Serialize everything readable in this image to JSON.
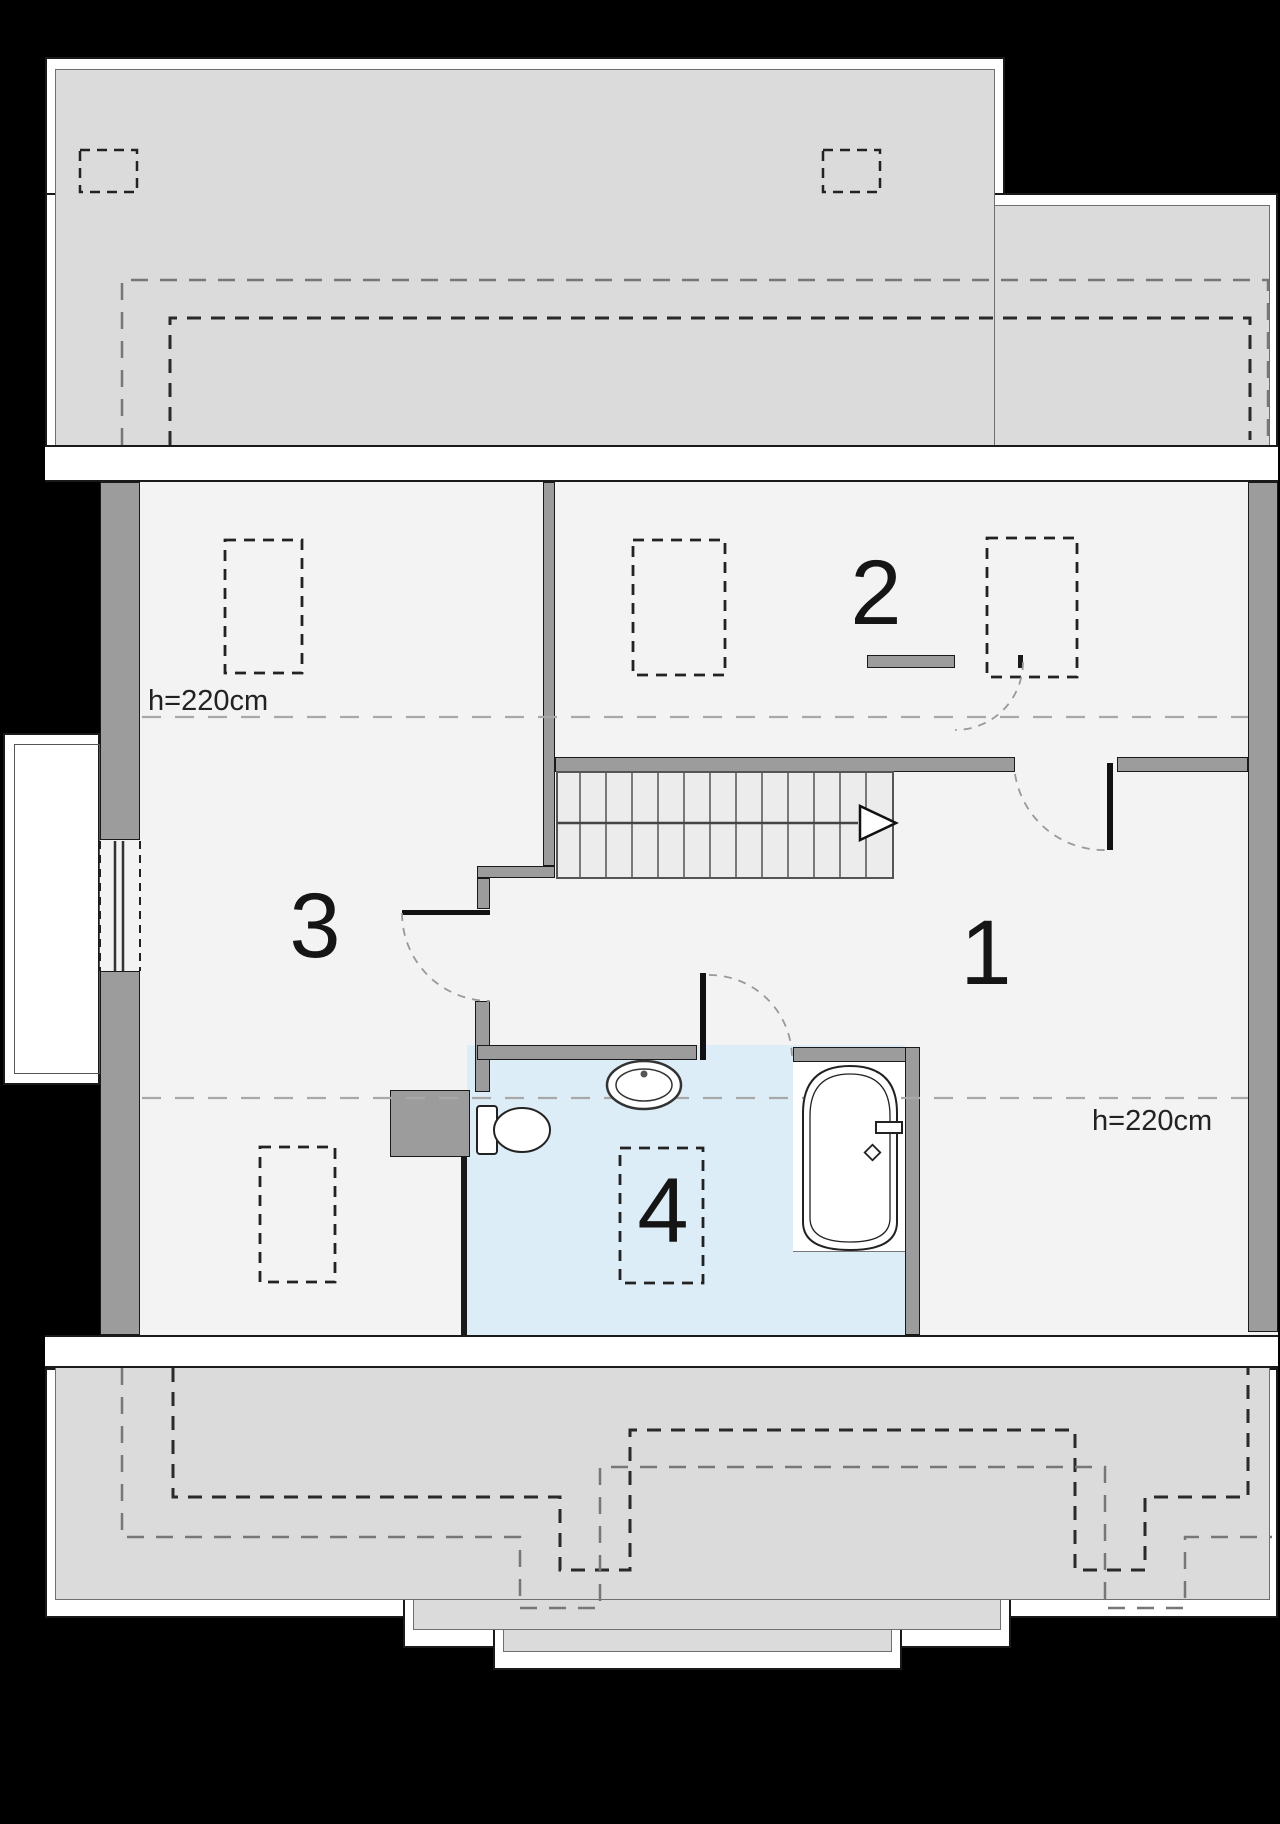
{
  "title": "Attic floor plan",
  "rooms": [
    {
      "number": "1"
    },
    {
      "number": "2"
    },
    {
      "number": "3"
    },
    {
      "number": "4"
    }
  ],
  "annotations": {
    "height_left": "h=220cm",
    "height_right": "h=220cm"
  },
  "fixtures": [
    "staircase",
    "direction-arrow",
    "bathtub",
    "washbasin",
    "toilet",
    "window",
    "door-swing"
  ],
  "colors": {
    "background": "#000000",
    "roof": "#dbdbdb",
    "floor": "#f3f3f3",
    "wall": "#9c9c9c",
    "bathroom": "#ddedf7",
    "stairs": "#ececec",
    "white": "#ffffff",
    "outline": "#1a1a1a",
    "dash_dark": "#2a2a2a",
    "dash_gray": "#777777",
    "height_line": "#a8a8a8"
  }
}
